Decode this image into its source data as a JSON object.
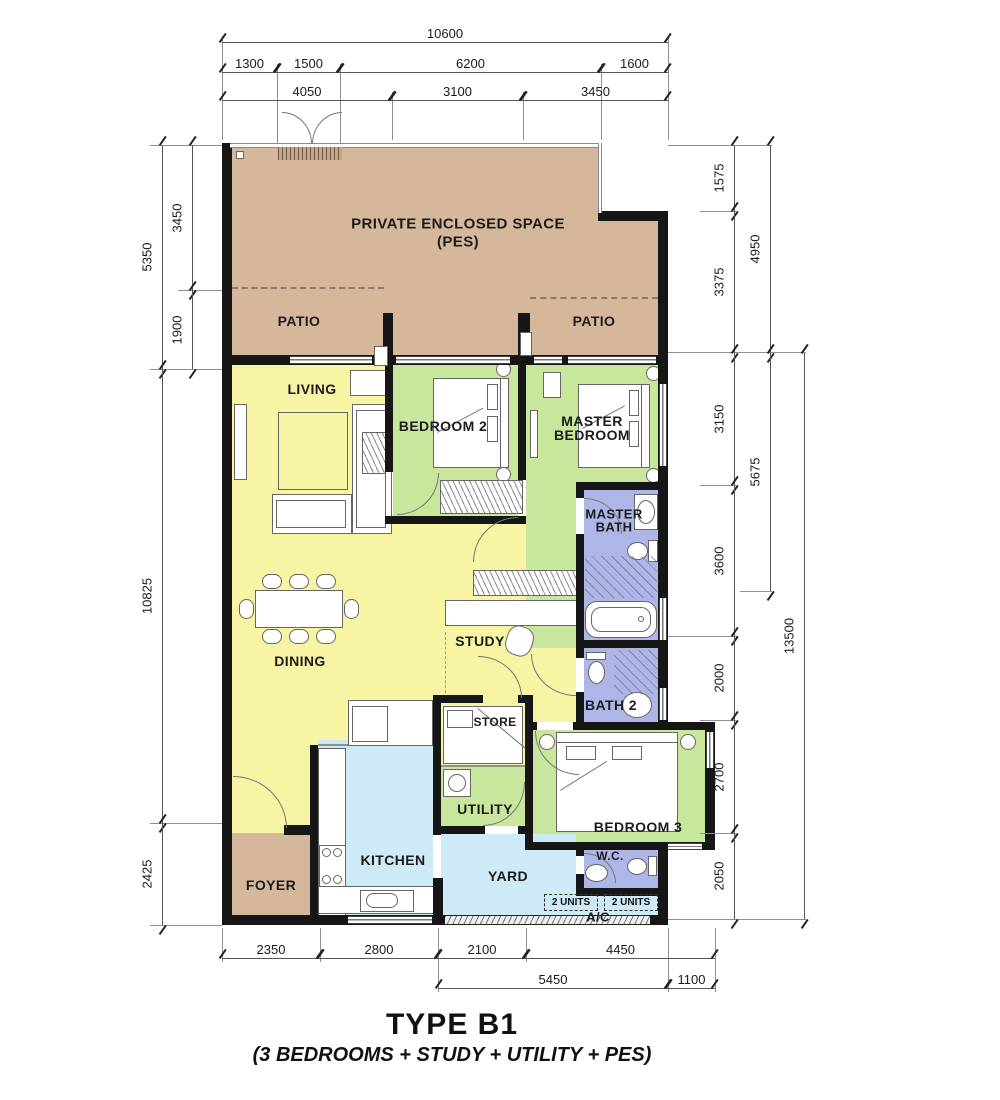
{
  "title": {
    "main": "TYPE B1",
    "subtitle": "(3 BEDROOMS + STUDY + UTILITY + PES)"
  },
  "rooms": {
    "pes1": "PRIVATE ENCLOSED SPACE",
    "pes2": "(PES)",
    "patio": "PATIO",
    "living": "LIVING",
    "dining": "DINING",
    "study": "STUDY",
    "store": "STORE",
    "utility": "UTILITY",
    "kitchen": "KITCHEN",
    "yard": "YARD",
    "foyer": "FOYER",
    "bedroom2": "BEDROOM 2",
    "master1": "MASTER",
    "master2": "BEDROOM",
    "masterbath1": "MASTER",
    "masterbath2": "BATH",
    "bath2": "BATH 2",
    "bedroom3": "BEDROOM 3",
    "wc": "W.C.",
    "ac": "A/C",
    "units": "2 UNITS"
  },
  "dims": {
    "top": [
      "10600",
      "1300",
      "1500",
      "6200",
      "1600",
      "4050",
      "3100",
      "3450"
    ],
    "left": [
      "5350",
      "3450",
      "1900",
      "10825",
      "2425"
    ],
    "right": [
      "1575",
      "3375",
      "3150",
      "3600",
      "2000",
      "2700",
      "2050",
      "4950",
      "5675",
      "13500"
    ],
    "bottom": [
      "2350",
      "2800",
      "2100",
      "4450",
      "5450",
      "1100"
    ]
  },
  "colors": {
    "tan": "#d5b79c",
    "yellow": "#f7f4a3",
    "green": "#c9e69d",
    "blue": "#adb6e6",
    "cyan": "#cfeaf7",
    "wall": "#161616"
  }
}
